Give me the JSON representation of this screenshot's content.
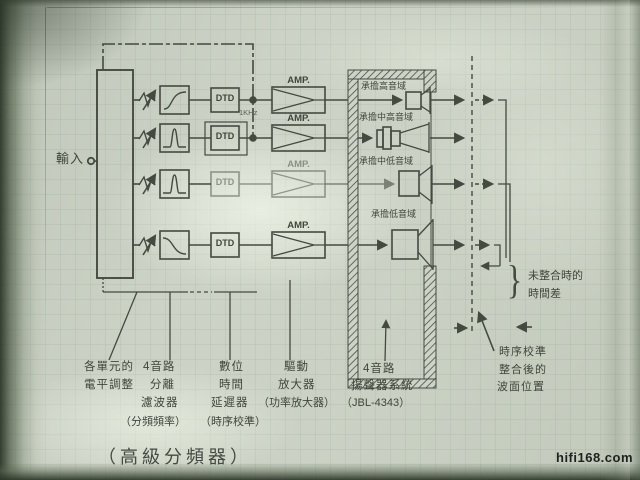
{
  "photo": {
    "watermark": "hifi168.com"
  },
  "diagram": {
    "caption": "（高級分頻器）",
    "input_label": "輸入",
    "freq_note": "1KHz",
    "dtd_label": "DTD",
    "amp_label": "AMP.",
    "cabinet": {
      "driver_labels": [
        "承擔高音域",
        "承擔中高音域",
        "承擔中低音域",
        "承擔低音域"
      ]
    },
    "callouts": {
      "level": [
        "各單元的",
        "電平調整"
      ],
      "filter": [
        "4音路",
        "分離",
        "濾波器",
        "（分頻頻率）"
      ],
      "delay": [
        "數位",
        "時間",
        "延遲器",
        "（時序校準）"
      ],
      "power": [
        "驅動",
        "放大器",
        "（功率放大器）"
      ],
      "speaker": [
        "4音路",
        "揚聲器系統",
        "（JBL-4343）"
      ],
      "aligned_wavefront": [
        "時序校準",
        "整合後的",
        "波面位置"
      ],
      "unaligned_delay": [
        "未整合時的",
        "時間差"
      ],
      "brace": "}"
    }
  }
}
